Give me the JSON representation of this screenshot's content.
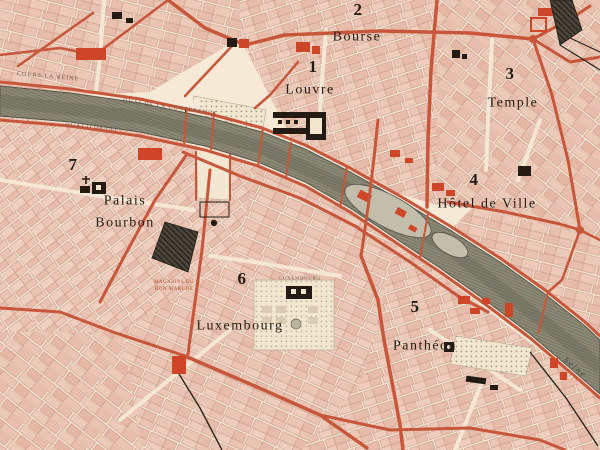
{
  "map": {
    "title": "Paris arrondissement map (vintage)",
    "districts": [
      {
        "number": "1",
        "name": "Louvre"
      },
      {
        "number": "2",
        "name": "Bourse"
      },
      {
        "number": "3",
        "name": "Temple"
      },
      {
        "number": "4",
        "name": "Hôtel de Ville"
      },
      {
        "number": "5",
        "name": "Panthéon"
      },
      {
        "number": "6",
        "name": "Luxembourg"
      },
      {
        "number": "7",
        "name": "Palais Bourbon"
      }
    ],
    "labels": {
      "river": "Seine",
      "quai_north": "COURS LA REINE",
      "quai_conference": "QUAI DE LA CONFERENCE",
      "quai_south": "QUAI D'ORSAY",
      "garden_luxembourg": "LUXEMBOURG",
      "store_line1": "MAGASINS DU",
      "store_line2": "BON MARCHÉ"
    },
    "colors": {
      "paper": "#f6e9d6",
      "block_pink": "#eac3b2",
      "street_red": "#c8563a",
      "building_red": "#cf4527",
      "river_olive": "#8b8976",
      "monument_black": "#241c14"
    }
  }
}
